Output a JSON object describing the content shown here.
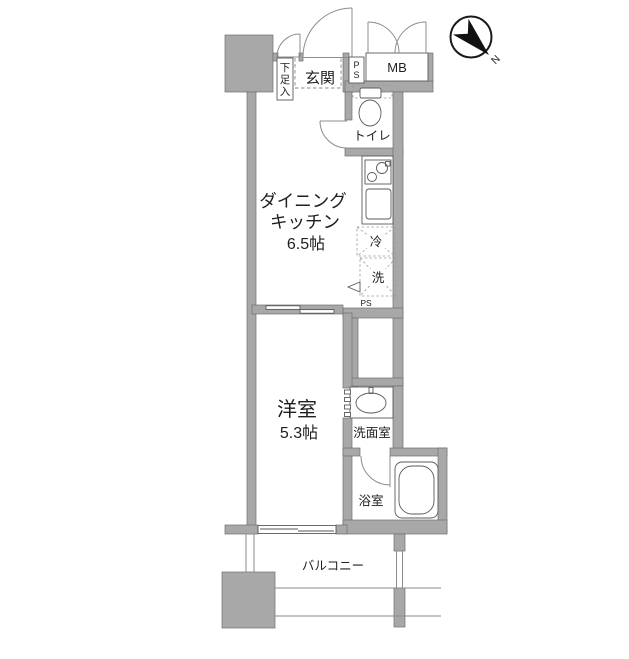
{
  "plan": {
    "type": "apartment-floor-plan",
    "compass": {
      "label": "N"
    },
    "labels": {
      "shoe_storage": "下足入",
      "shoe_storage_chars": [
        "下",
        "足",
        "入"
      ],
      "entrance": "玄関",
      "pipe_space_top": "PS",
      "pipe_space_top_chars": [
        "P",
        "S"
      ],
      "meter_box": "MB",
      "toilet": "トイレ",
      "dining_kitchen_line1": "ダイニング",
      "dining_kitchen_line2": "キッチン",
      "dining_kitchen_size": "6.5帖",
      "refrigerator": "冷",
      "washer": "洗",
      "pipe_space_bottom": "PS",
      "western_room": "洋室",
      "western_room_size": "5.3帖",
      "washroom": "洗面室",
      "bathroom": "浴室",
      "balcony": "バルコニー"
    },
    "rooms": [
      {
        "name": "ダイニングキッチン",
        "size": "6.5帖"
      },
      {
        "name": "洋室",
        "size": "5.3帖"
      }
    ],
    "colors": {
      "wall": "#a8a8a8",
      "wall_outline": "#6f6f6f",
      "fixture_line": "#5a5a5a",
      "text": "#1f1f1f",
      "background": "#ffffff"
    }
  }
}
